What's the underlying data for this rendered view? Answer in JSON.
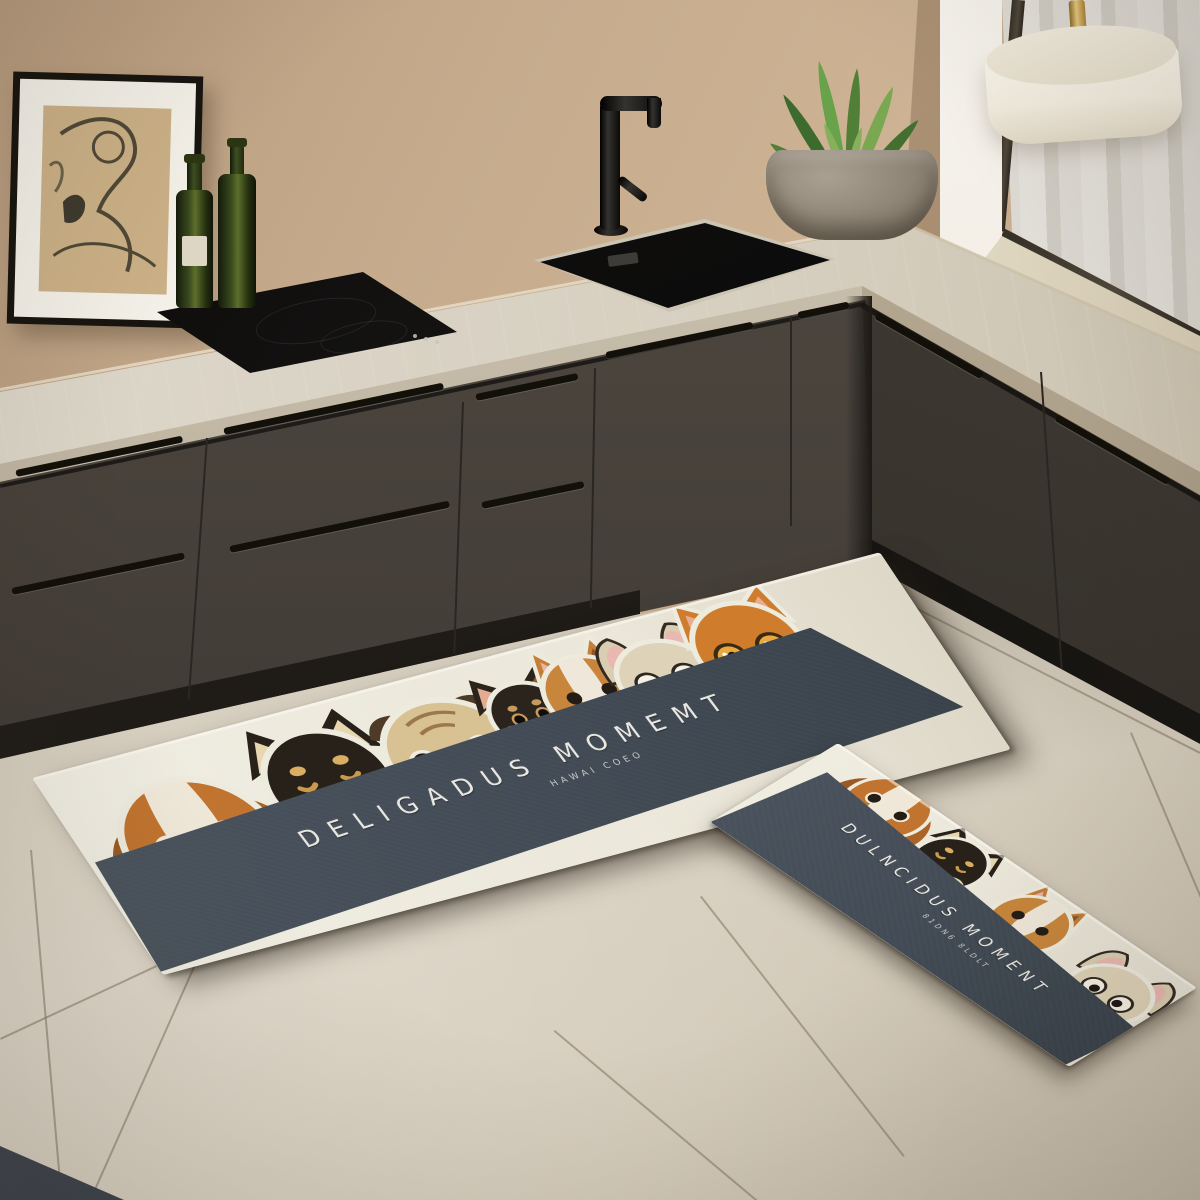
{
  "scene": {
    "setting": "modern beige kitchen corner with black fixtures",
    "wall_color": "#c6ab8d",
    "counter_color": "#d8d2c4",
    "cabinet_color": "#46413b",
    "floor_tile_color": "#cfc6b6",
    "window": {
      "frame_color": "#4f473a",
      "curtain_color": "#edebe5"
    },
    "lamp": {
      "shade_color": "#f4efe4",
      "stem_color": "#c29a4b"
    },
    "plant": {
      "leaf_color": "#4e7d38",
      "pot_color": "#94897a"
    },
    "bottles": {
      "count": 2,
      "glass_color": "#3a451c"
    },
    "art": {
      "frame_color": "#17140f",
      "paper_color": "#cbb086"
    },
    "sink_color": "#0b0b0a",
    "faucet_color": "#121110"
  },
  "mats": {
    "large": {
      "title": "DELIGADUS MOMEMT",
      "subtitle": "HAWAI COEO",
      "base_color": "#edeade",
      "band_color": "#424b55",
      "text_color": "#e8e7e3",
      "dogs": [
        "beagle",
        "black-shiba",
        "pug",
        "chihuahua",
        "corgi",
        "french-bulldog",
        "orange-cat"
      ]
    },
    "small": {
      "title": "DULNCIDUS MOMENT",
      "subtitle": "81DN6 8LDLT",
      "base_color": "#edeade",
      "band_color": "#424b55",
      "text_color": "#e8e7e3",
      "dogs": [
        "beagle",
        "black-shiba",
        "corgi",
        "french-bulldog"
      ]
    }
  }
}
